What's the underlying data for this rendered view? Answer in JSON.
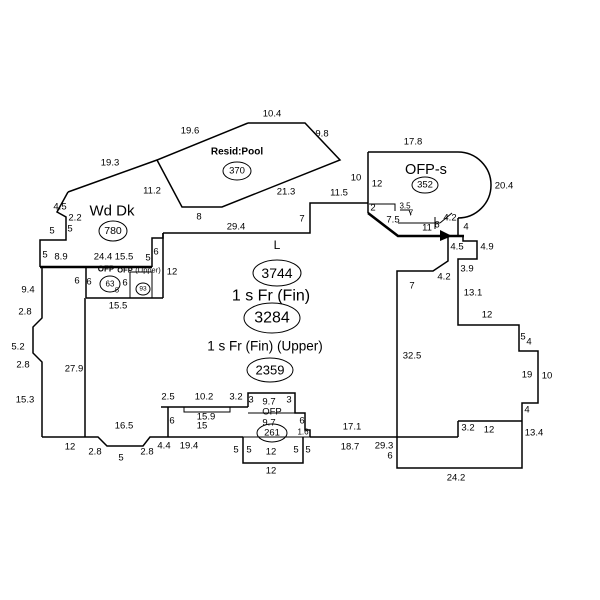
{
  "sketch": {
    "canvas": {
      "width": 600,
      "height": 600,
      "background": "#ffffff",
      "line_color": "#000000"
    },
    "areas": [
      {
        "name": "resid-pool",
        "label": "Resid:Pool",
        "area_value": "370"
      },
      {
        "name": "wood-deck",
        "label": "Wd Dk",
        "area_value": "780"
      },
      {
        "name": "ofp-s",
        "label": "OFP-s",
        "area_value": "352"
      },
      {
        "name": "living",
        "label": "L",
        "area_value": "3744"
      },
      {
        "name": "first-floor",
        "label": "1 s Fr (Fin)",
        "area_value": "3284"
      },
      {
        "name": "upper-floor",
        "label": "1 s Fr (Fin)  (Upper)",
        "area_value": "2359"
      },
      {
        "name": "ofp-left",
        "label": "OFP",
        "area_value": "63"
      },
      {
        "name": "ofp-left-upper",
        "label": "OFP (Upper)",
        "area_value": "93"
      },
      {
        "name": "ofp-bottom",
        "label": "OFP",
        "area_value": "261"
      }
    ],
    "text_labels": [
      {
        "name": "area-label-resid-pool",
        "text": "Resid:Pool",
        "x": 237,
        "y": 152,
        "size": 10,
        "bold": true
      },
      {
        "name": "area-label-wd-dk",
        "text": "Wd Dk",
        "x": 112,
        "y": 211,
        "size": 15,
        "bold": false
      },
      {
        "name": "area-label-ofp-s",
        "text": "OFP-s",
        "x": 426,
        "y": 170,
        "size": 14.5,
        "bold": false
      },
      {
        "name": "area-label-living-code",
        "text": "L",
        "x": 277,
        "y": 245,
        "size": 12,
        "bold": false
      },
      {
        "name": "area-label-first-floor",
        "text": "1 s Fr (Fin)",
        "x": 271,
        "y": 296,
        "size": 16,
        "bold": false
      },
      {
        "name": "area-label-upper-floor",
        "text": "1 s Fr (Fin)  (Upper)",
        "x": 265,
        "y": 346,
        "size": 13.5,
        "bold": false
      },
      {
        "name": "area-label-ofp-left",
        "text": "OFP",
        "x": 106,
        "y": 269,
        "size": 8,
        "bold": true
      },
      {
        "name": "area-label-ofp-left-2",
        "text": "OFP",
        "x": 125,
        "y": 270,
        "size": 7.5,
        "bold": true
      },
      {
        "name": "area-label-ofp-left-upper",
        "text": "(Upper)",
        "x": 148,
        "y": 270,
        "size": 7.5,
        "bold": false
      },
      {
        "name": "area-label-ofp-bottom",
        "text": "OFP",
        "x": 272,
        "y": 412,
        "size": 9.5,
        "bold": false
      }
    ],
    "circled_values": [
      {
        "name": "circled-area-370",
        "text": "370",
        "cx": 237,
        "cy": 171,
        "rx": 14,
        "ry": 9,
        "size": 9.5
      },
      {
        "name": "circled-area-780",
        "text": "780",
        "cx": 113,
        "cy": 231,
        "rx": 14,
        "ry": 10,
        "size": 10.5
      },
      {
        "name": "circled-area-352",
        "text": "352",
        "cx": 425,
        "cy": 185,
        "rx": 13,
        "ry": 8,
        "size": 9.5
      },
      {
        "name": "circled-area-3744",
        "text": "3744",
        "cx": 277,
        "cy": 273,
        "rx": 24,
        "ry": 13,
        "size": 14
      },
      {
        "name": "circled-area-3284",
        "text": "3284",
        "cx": 272,
        "cy": 318,
        "rx": 28,
        "ry": 15,
        "size": 16
      },
      {
        "name": "circled-area-2359",
        "text": "2359",
        "cx": 270,
        "cy": 370,
        "rx": 23,
        "ry": 12,
        "size": 13
      },
      {
        "name": "circled-area-63",
        "text": "63",
        "cx": 110,
        "cy": 284,
        "rx": 10,
        "ry": 8,
        "size": 8
      },
      {
        "name": "circled-area-93",
        "text": "93",
        "cx": 143,
        "cy": 289,
        "rx": 7,
        "ry": 6,
        "size": 6.5
      },
      {
        "name": "circled-area-261",
        "text": "261",
        "cx": 272,
        "cy": 433,
        "rx": 15,
        "ry": 9,
        "size": 9.5
      }
    ],
    "dim_labels": [
      {
        "t": "10.4",
        "x": 272,
        "y": 114
      },
      {
        "t": "19.6",
        "x": 190,
        "y": 131
      },
      {
        "t": "9.8",
        "x": 322,
        "y": 134
      },
      {
        "t": "17.8",
        "x": 413,
        "y": 142
      },
      {
        "t": "19.3",
        "x": 110,
        "y": 163
      },
      {
        "t": "11.2",
        "x": 152,
        "y": 191
      },
      {
        "t": "21.3",
        "x": 286,
        "y": 192
      },
      {
        "t": "10",
        "x": 356,
        "y": 178
      },
      {
        "t": "12",
        "x": 377,
        "y": 184
      },
      {
        "t": "20.4",
        "x": 504,
        "y": 186
      },
      {
        "t": "11.5",
        "x": 339,
        "y": 193
      },
      {
        "t": "2",
        "x": 373,
        "y": 208
      },
      {
        "t": "3.5",
        "x": 405,
        "y": 206,
        "s": 8
      },
      {
        "t": "7",
        "x": 411,
        "y": 213,
        "s": 8
      },
      {
        "t": "7.5",
        "x": 393,
        "y": 220
      },
      {
        "t": "11",
        "x": 427,
        "y": 228
      },
      {
        "t": "6",
        "x": 437,
        "y": 225
      },
      {
        "t": "4.2",
        "x": 450,
        "y": 218
      },
      {
        "t": "4",
        "x": 466,
        "y": 227
      },
      {
        "t": "8",
        "x": 199,
        "y": 217
      },
      {
        "t": "29.4",
        "x": 236,
        "y": 227
      },
      {
        "t": "7",
        "x": 302,
        "y": 219
      },
      {
        "t": "4.5",
        "x": 457,
        "y": 247
      },
      {
        "t": "4.9",
        "x": 487,
        "y": 247
      },
      {
        "t": "3.9",
        "x": 467,
        "y": 269
      },
      {
        "t": "4.2",
        "x": 444,
        "y": 277
      },
      {
        "t": "7",
        "x": 412,
        "y": 286
      },
      {
        "t": "13.1",
        "x": 473,
        "y": 293
      },
      {
        "t": "4.5",
        "x": 60,
        "y": 207
      },
      {
        "t": "2.2",
        "x": 75,
        "y": 218
      },
      {
        "t": "5",
        "x": 52,
        "y": 231
      },
      {
        "t": "5",
        "x": 70,
        "y": 229
      },
      {
        "t": "5",
        "x": 45,
        "y": 255
      },
      {
        "t": "8.9",
        "x": 61,
        "y": 257
      },
      {
        "t": "24.4",
        "x": 103,
        "y": 257
      },
      {
        "t": "15.5",
        "x": 124,
        "y": 257
      },
      {
        "t": "5",
        "x": 148,
        "y": 258
      },
      {
        "t": "6",
        "x": 156,
        "y": 252
      },
      {
        "t": "12",
        "x": 172,
        "y": 272
      },
      {
        "t": "6",
        "x": 77,
        "y": 281
      },
      {
        "t": "6",
        "x": 89,
        "y": 282
      },
      {
        "t": "6",
        "x": 125,
        "y": 283
      },
      {
        "t": "5",
        "x": 117,
        "y": 290,
        "s": 7.5
      },
      {
        "t": "15.5",
        "x": 118,
        "y": 306
      },
      {
        "t": "9.4",
        "x": 28,
        "y": 290
      },
      {
        "t": "2.8",
        "x": 25,
        "y": 312
      },
      {
        "t": "5.2",
        "x": 18,
        "y": 347
      },
      {
        "t": "2.8",
        "x": 23,
        "y": 365
      },
      {
        "t": "27.9",
        "x": 74,
        "y": 369
      },
      {
        "t": "15.3",
        "x": 25,
        "y": 400
      },
      {
        "t": "12",
        "x": 70,
        "y": 447
      },
      {
        "t": "2.8",
        "x": 95,
        "y": 452
      },
      {
        "t": "5",
        "x": 121,
        "y": 458
      },
      {
        "t": "2.8",
        "x": 147,
        "y": 452
      },
      {
        "t": "4.4",
        "x": 164,
        "y": 446
      },
      {
        "t": "19.4",
        "x": 189,
        "y": 446
      },
      {
        "t": "16.5",
        "x": 124,
        "y": 426
      },
      {
        "t": "2.5",
        "x": 168,
        "y": 397
      },
      {
        "t": "10.2",
        "x": 204,
        "y": 397
      },
      {
        "t": "3.2",
        "x": 236,
        "y": 397
      },
      {
        "t": "3",
        "x": 251,
        "y": 400
      },
      {
        "t": "9.7",
        "x": 269,
        "y": 402
      },
      {
        "t": "3",
        "x": 289,
        "y": 400
      },
      {
        "t": "15.9",
        "x": 206,
        "y": 417
      },
      {
        "t": "15",
        "x": 202,
        "y": 426
      },
      {
        "t": "6",
        "x": 172,
        "y": 421
      },
      {
        "t": "9.7",
        "x": 269,
        "y": 423
      },
      {
        "t": "6",
        "x": 302,
        "y": 421
      },
      {
        "t": "1.6",
        "x": 303,
        "y": 432,
        "s": 8
      },
      {
        "t": "5",
        "x": 236,
        "y": 450
      },
      {
        "t": "5",
        "x": 249,
        "y": 450
      },
      {
        "t": "12",
        "x": 271,
        "y": 452
      },
      {
        "t": "5",
        "x": 296,
        "y": 450
      },
      {
        "t": "5",
        "x": 308,
        "y": 450
      },
      {
        "t": "12",
        "x": 271,
        "y": 471
      },
      {
        "t": "17.1",
        "x": 352,
        "y": 427
      },
      {
        "t": "18.7",
        "x": 350,
        "y": 447
      },
      {
        "t": "29.3",
        "x": 384,
        "y": 446
      },
      {
        "t": "6",
        "x": 390,
        "y": 456
      },
      {
        "t": "32.5",
        "x": 412,
        "y": 356
      },
      {
        "t": "12",
        "x": 487,
        "y": 315
      },
      {
        "t": "5",
        "x": 523,
        "y": 337
      },
      {
        "t": "4",
        "x": 529,
        "y": 342
      },
      {
        "t": "19",
        "x": 527,
        "y": 375
      },
      {
        "t": "10",
        "x": 547,
        "y": 376
      },
      {
        "t": "4",
        "x": 527,
        "y": 410
      },
      {
        "t": "3.2",
        "x": 468,
        "y": 428
      },
      {
        "t": "12",
        "x": 489,
        "y": 430
      },
      {
        "t": "13.4",
        "x": 534,
        "y": 433
      },
      {
        "t": "24.2",
        "x": 456,
        "y": 478
      }
    ],
    "polylines": [
      {
        "pts": "248,123 305,123 340,160 222,207 182,207 157,160 248,123",
        "w": 1.5
      },
      {
        "pts": "157,160 68,192",
        "w": 1.5
      },
      {
        "pts": "68,192 57,212 66,217 66,240 40,240 40,267",
        "w": 1.5
      },
      {
        "pts": "40,267 152,267",
        "w": 2.6
      },
      {
        "pts": "152,267 152,238 163,238 163,233",
        "w": 1.5
      },
      {
        "pts": "163,233 310,233 310,203 368,203",
        "w": 1.5
      },
      {
        "pts": "368,152 368,213",
        "w": 1.5
      },
      {
        "pts": "368,213 398,236 464,236",
        "w": 2.6
      },
      {
        "pts": "368,152 458,152",
        "w": 1.5
      },
      {
        "pts": "458,218 458,236",
        "w": 1.5
      },
      {
        "pts": "398,223 440,223",
        "w": 1
      },
      {
        "pts": "435,217 435,229",
        "w": 1
      },
      {
        "pts": "440,223 452,213",
        "w": 1
      },
      {
        "pts": "369,204 395,204 395,211",
        "w": 1
      },
      {
        "pts": "400,210 409,210 411,215",
        "w": 1
      },
      {
        "pts": "448,236 448,261 433,271 397,271 397,468 522,468 522,403 538,403 538,351 519,351 519,325 458,325 458,259 477,259 477,241 463,241 463,236",
        "w": 1.5
      },
      {
        "pts": "458,421 522,421",
        "w": 1.5
      },
      {
        "pts": "458,421 458,437",
        "w": 1.5
      },
      {
        "pts": "310,437 458,437",
        "w": 1.5
      },
      {
        "pts": "161,407 248,407",
        "w": 1.5
      },
      {
        "pts": "184,407 184,412 230,412 230,407",
        "w": 1
      },
      {
        "pts": "168,407 168,437",
        "w": 1.5
      },
      {
        "pts": "248,407 248,393 295,393 295,413 305,413 305,430 310,430 310,437",
        "w": 1.5
      },
      {
        "pts": "248,413 295,413",
        "w": 1
      },
      {
        "pts": "243,437 243,463 303,463 303,437",
        "w": 1.5
      },
      {
        "pts": "243,437 310,437",
        "w": 1
      },
      {
        "pts": "42,437 98,437 107,446 143,446 150,437 243,437",
        "w": 1.5
      },
      {
        "pts": "42,267 42,318 33,327 33,353 42,362 42,437",
        "w": 1.5
      },
      {
        "pts": "86,267 86,298",
        "w": 1.5
      },
      {
        "pts": "86,298 163,298",
        "w": 1.5
      },
      {
        "pts": "130,272 152,272",
        "w": 1
      },
      {
        "pts": "130,272 130,298",
        "w": 1
      },
      {
        "pts": "152,272 152,298",
        "w": 1
      },
      {
        "pts": "163,233 163,298",
        "w": 1.5
      },
      {
        "pts": "85,298 85,437",
        "w": 1.5
      }
    ],
    "paths": [
      {
        "d": "M458,152 A33,33 0 0 1 458,218",
        "w": 1.5
      }
    ],
    "arrow": {
      "points": "440,230 452,236 440,241"
    }
  }
}
